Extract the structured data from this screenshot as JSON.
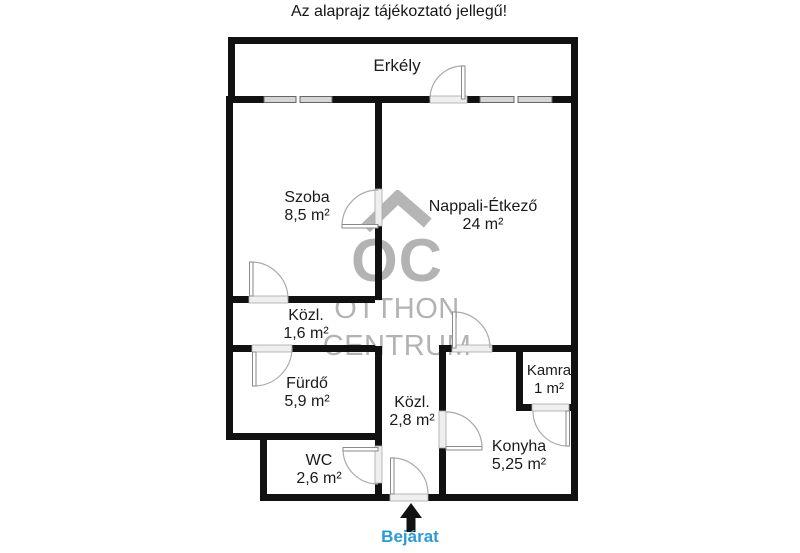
{
  "title": "Az alaprajz tájékoztató jellegű!",
  "watermark": {
    "logo": "OC",
    "line1": "OTTHON",
    "line2": "CENTRUM"
  },
  "entrance": {
    "label": "Bejárat"
  },
  "rooms": [
    {
      "name": "Erkély",
      "area": ""
    },
    {
      "name": "Szoba",
      "area": "8,5 m²"
    },
    {
      "name": "Nappali-Étkező",
      "area": "24 m²"
    },
    {
      "name": "Közl.",
      "area": "1,6 m²"
    },
    {
      "name": "Fürdő",
      "area": "5,9 m²"
    },
    {
      "name": "Közl.",
      "area": "2,8 m²"
    },
    {
      "name": "Kamra",
      "area": "1 m²"
    },
    {
      "name": "Konyha",
      "area": "5,25 m²"
    },
    {
      "name": "WC",
      "area": "2,6 m²"
    }
  ],
  "colors": {
    "wall": "#111111",
    "text": "#1a1a1a",
    "entrance_label": "#2E9AD3",
    "watermark": "#b3b3b3",
    "window_fill": "#d6d6d6",
    "opening_fill": "#efefef"
  }
}
